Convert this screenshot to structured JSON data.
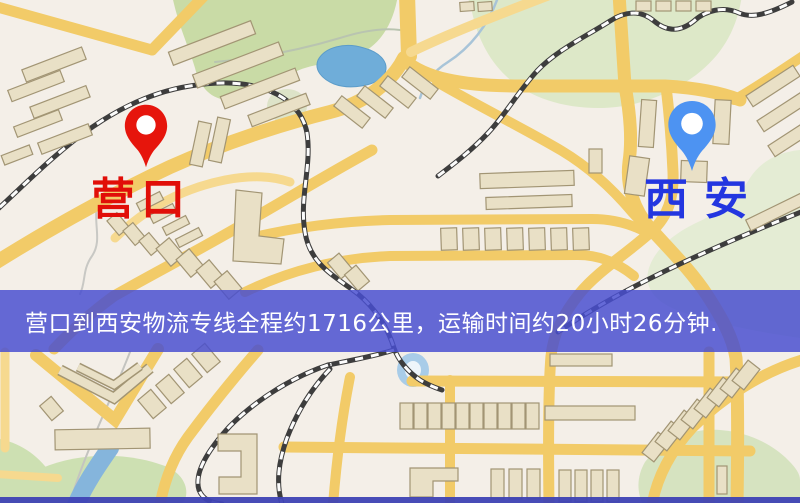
{
  "window": {
    "width": 800,
    "height": 503
  },
  "map": {
    "style": "street-map",
    "markers": {
      "origin": {
        "label": "营口",
        "pin_color": "#e6150c",
        "label_color": "#e10e08"
      },
      "destination": {
        "label": "西安",
        "pin_color": "#4d93f2",
        "label_color": "#2336e0"
      }
    },
    "banner": {
      "text": "营口到西安物流专线全程约1716公里，运输时间约20小时26分钟.",
      "background": "#484ecf",
      "text_color": "#ffffff"
    },
    "route": {
      "from": "营口",
      "to": "西安",
      "distance_km": "1716",
      "duration": "20小时26分钟"
    },
    "palette": {
      "background": "#f4efe8",
      "road": "#f2cb68",
      "building": "#e9e0c6",
      "park": "#cfe0b2",
      "water": "#6fadd9",
      "railway": "#3d3d3d"
    }
  }
}
